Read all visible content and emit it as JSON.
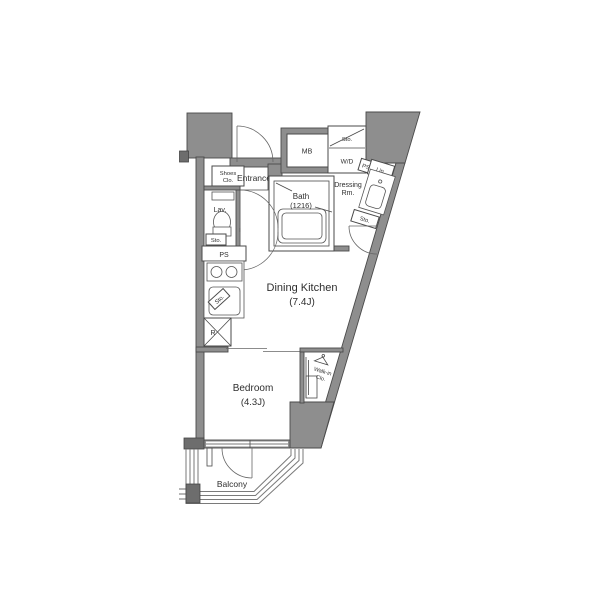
{
  "floorplan": {
    "colors": {
      "wall_fill": "#8e8e8e",
      "wall_dark": "#6d6d6d",
      "line": "#4a4a4a",
      "background": "#ffffff"
    },
    "labels": {
      "entrance": "Entrance",
      "shoes_clo_line1": "Shoes",
      "shoes_clo_line2": "Clo.",
      "lav": "Lav.",
      "sto_lav": "Sto.",
      "ps_left": "PS",
      "mb": "MB",
      "sto_wd": "Sto.",
      "wd": "W/D",
      "ps_right": "PS",
      "lin": "Lin.",
      "dressing_line1": "Dressing",
      "dressing_line2": "Rm.",
      "bath_line1": "Bath",
      "bath_line2": "(1216)",
      "sto_dressing": "Sto.",
      "dining_kitchen_line1": "Dining Kitchen",
      "dining_kitchen_line2": "(7.4J)",
      "sto_kitchen": "Sto.",
      "fridge": "R",
      "bedroom_line1": "Bedroom",
      "bedroom_line2": "(4.3J)",
      "walkin_line1": "Walk-in",
      "walkin_line2": "Clo.",
      "balcony": "Balcony"
    }
  }
}
